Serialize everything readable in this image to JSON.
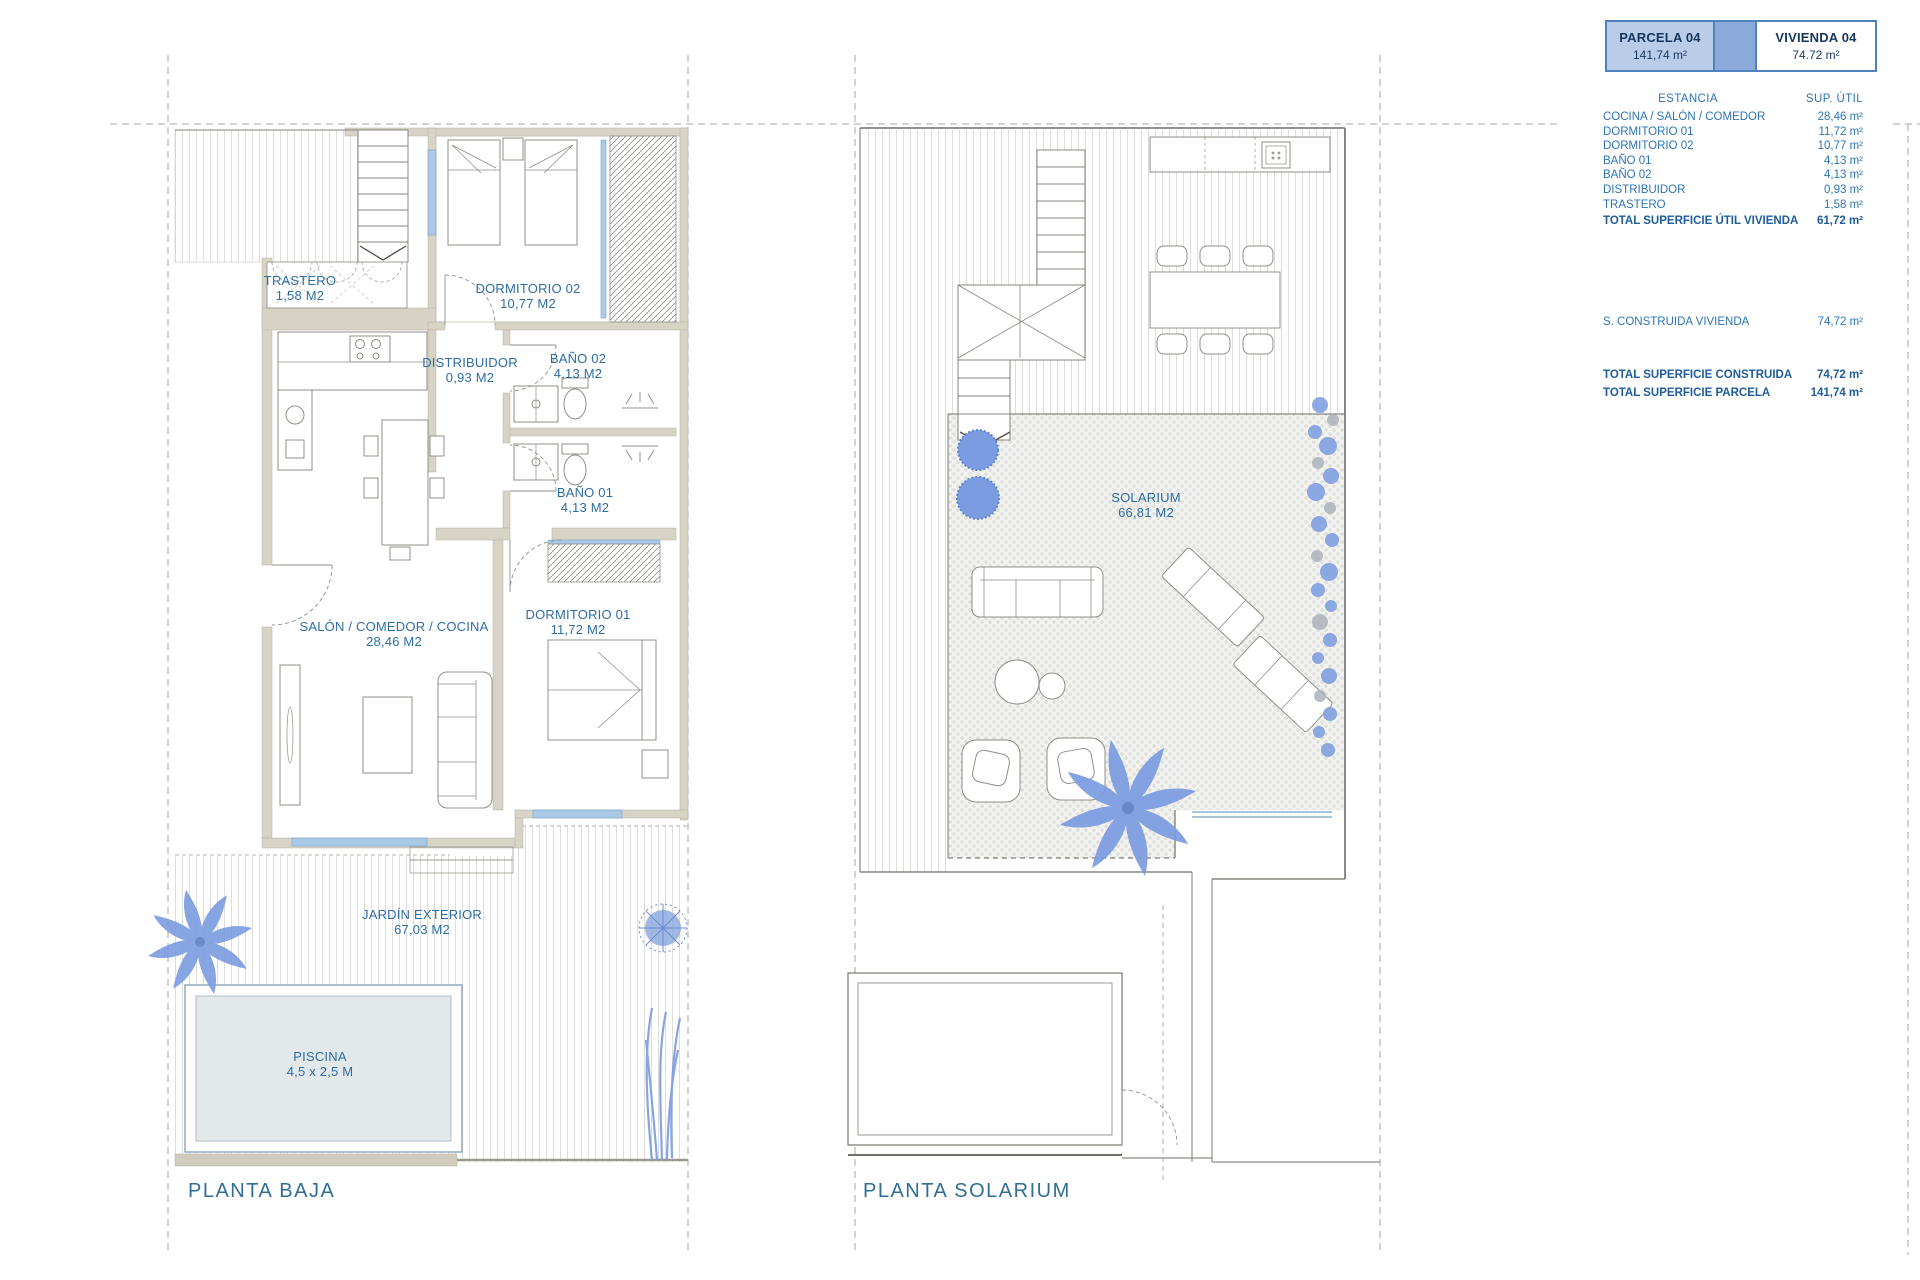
{
  "header": {
    "parcela": {
      "label": "PARCELA 04",
      "area": "141,74 m²"
    },
    "vivienda": {
      "label": "VIVIENDA 04",
      "area": "74.72 m²"
    }
  },
  "summary": {
    "col_estancia": "ESTANCIA",
    "col_sup": "SUP. ÚTIL",
    "rows": [
      {
        "label": "COCINA / SALÓN / COMEDOR",
        "value": "28,46 m²"
      },
      {
        "label": "DORMITORIO 01",
        "value": "11,72 m²"
      },
      {
        "label": "DORMITORIO 02",
        "value": "10,77 m²"
      },
      {
        "label": "BAÑO 01",
        "value": "4,13 m²"
      },
      {
        "label": "BAÑO 02",
        "value": "4,13 m²"
      },
      {
        "label": "DISTRIBUIDOR",
        "value": "0,93 m²"
      },
      {
        "label": "TRASTERO",
        "value": "1,58 m²"
      }
    ],
    "total_util": {
      "label": "TOTAL SUPERFICIE ÚTIL VIVIENDA",
      "value": "61,72 m²"
    },
    "construida": {
      "label": "S. CONSTRUIDA VIVIENDA",
      "value": "74,72 m²"
    },
    "total_construida": {
      "label": "TOTAL SUPERFICIE CONSTRUIDA",
      "value": "74,72 m²"
    },
    "total_parcela": {
      "label": "TOTAL SUPERFICIE PARCELA",
      "value": "141,74 m²"
    }
  },
  "pb": {
    "title": "PLANTA BAJA",
    "rooms": {
      "trastero": {
        "name": "TRASTERO",
        "area": "1,58 M2"
      },
      "dormitorio02": {
        "name": "DORMITORIO 02",
        "area": "10,77 M2"
      },
      "distribuidor": {
        "name": "DISTRIBUIDOR",
        "area": "0,93 M2"
      },
      "bano02": {
        "name": "BAÑO 02",
        "area": "4,13 M2"
      },
      "bano01": {
        "name": "BAÑO 01",
        "area": "4,13 M2"
      },
      "salon": {
        "name": "SALÓN / COMEDOR / COCINA",
        "area": "28,46 M2"
      },
      "dormitorio01": {
        "name": "DORMITORIO 01",
        "area": "11,72 M2"
      },
      "jardin": {
        "name": "JARDÍN EXTERIOR",
        "area": "67,03 M2"
      },
      "piscina": {
        "name": "PISCINA",
        "area": "4,5 x 2,5 M"
      }
    }
  },
  "ps": {
    "title": "PLANTA SOLARIUM",
    "rooms": {
      "solarium": {
        "name": "SOLARIUM",
        "area": "66,81 M2"
      }
    }
  },
  "colors": {
    "accent_blue": "#4f81bd",
    "label_blue": "#2e6da4",
    "plant_blue": "#7b9ce0",
    "wall_beige": "#d7d4c6"
  }
}
